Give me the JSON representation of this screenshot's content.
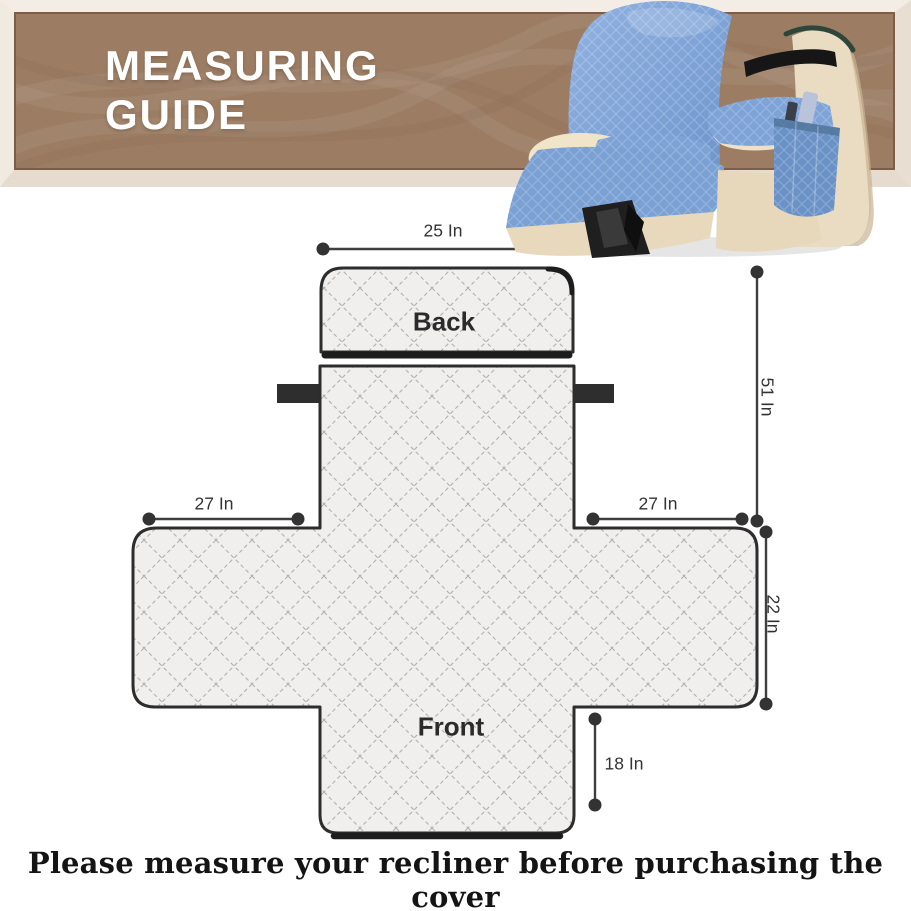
{
  "banner": {
    "title_line1": "MEASURING",
    "title_line2": "GUIDE"
  },
  "diagram": {
    "back_label": "Back",
    "front_label": "Front",
    "dims": {
      "back_width": "25 In",
      "total_length": "51 In",
      "left_wing": "27 In",
      "right_wing": "27 In",
      "seat_side": "22 In",
      "front_drop": "18 In"
    }
  },
  "footer": {
    "note": "Please measure your recliner before purchasing the cover"
  },
  "colors": {
    "banner_brown": "#9c7d64",
    "banner_border": "#7b5d49",
    "outline_dark": "#2d2d2d",
    "quilt_fill": "#f0efee",
    "quilt_line": "#b3b1ae",
    "cover_blue": "#7da2d6",
    "chair_beige": "#e9dcc2",
    "strap_black": "#2e2e2e"
  }
}
